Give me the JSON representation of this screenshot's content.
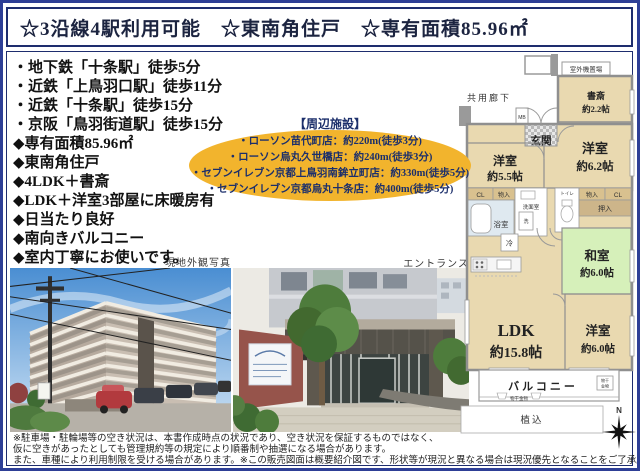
{
  "header": {
    "title": "☆3沿線4駅利用可能　☆東南角住戸　☆専有面積85.96㎡"
  },
  "features": [
    "・地下鉄「十条駅」徒歩5分",
    "・近鉄「上鳥羽口駅」徒歩11分",
    "・近鉄「十条駅」徒歩15分",
    "・京阪「鳥羽街道駅」徒歩15分",
    "◆専有面積85.96㎡",
    "◆東南角住戸",
    "◆4LDK＋書斎",
    "◆LDK＋洋室3部屋に床暖房有",
    "◆日当たり良好",
    "◆南向きバルコニー",
    "◆室内丁寧にお使いです。"
  ],
  "nearby": {
    "title": "【周辺施設】",
    "items": [
      "・ローソン苗代町店：約220m(徒歩3分)",
      "・ローソン烏丸久世橋店：約240m(徒歩3分)",
      "・セブンイレブン京都上鳥羽南鉾立町店：約330m(徒歩5分)",
      "・セブンイレブン京都烏丸十条店：約400m(徒歩5分)"
    ]
  },
  "photos": {
    "exterior_label": "現地外観写真",
    "entrance_label": "エントランス"
  },
  "floorplan": {
    "corridor_label": "共用廊下",
    "outdoor_unit_label": "室外機置場",
    "mb_label": "MB",
    "entrance_label": "玄関",
    "study_name": "書斎",
    "study_size": "約2.2帖",
    "bedroom1_name": "洋室",
    "bedroom1_size": "約5.5帖",
    "bedroom2_name": "洋室",
    "bedroom2_size": "約6.2帖",
    "bedroom3_name": "洋室",
    "bedroom3_size": "約6.0帖",
    "japanese_name": "和室",
    "japanese_size": "約6.0帖",
    "ldk_name": "LDK",
    "ldk_size": "約15.8帖",
    "closet_label": "CL",
    "storage_label": "物入",
    "oshiire_label": "押入",
    "washroom_label": "洗面室",
    "washer_label": "洗",
    "bath_label": "浴室",
    "toilet_label": "トイレ",
    "fridge_label": "冷",
    "balcony_label": "バルコニー",
    "laundry_label": "物干金物",
    "laundry_box_line1": "物干",
    "laundry_box_line2": "金物",
    "planting_label": "植込",
    "north_label": "N"
  },
  "disclaimer": {
    "lines": [
      "※駐車場・駐輪場等の空き状況は、本書作成時点の状況であり、空き状況を保証するものではなく、",
      "仮に空きがあったとしても管理規約等の規定により順番制や抽選になる場合があります。",
      "また、車種により利用制限を受ける場合があります。※この販売図面は概要紹介図です、形状等が現況と異なる場合は現況優先となることをご了承願います。"
    ]
  },
  "colors": {
    "page_border": "#2e3f96",
    "box_border": "#1e2d6e",
    "oval_bg": "#f2b42d",
    "room_beige": "#e9d9b0",
    "room_green": "#d6f0ba",
    "wall_gray": "#8f8f8f"
  }
}
